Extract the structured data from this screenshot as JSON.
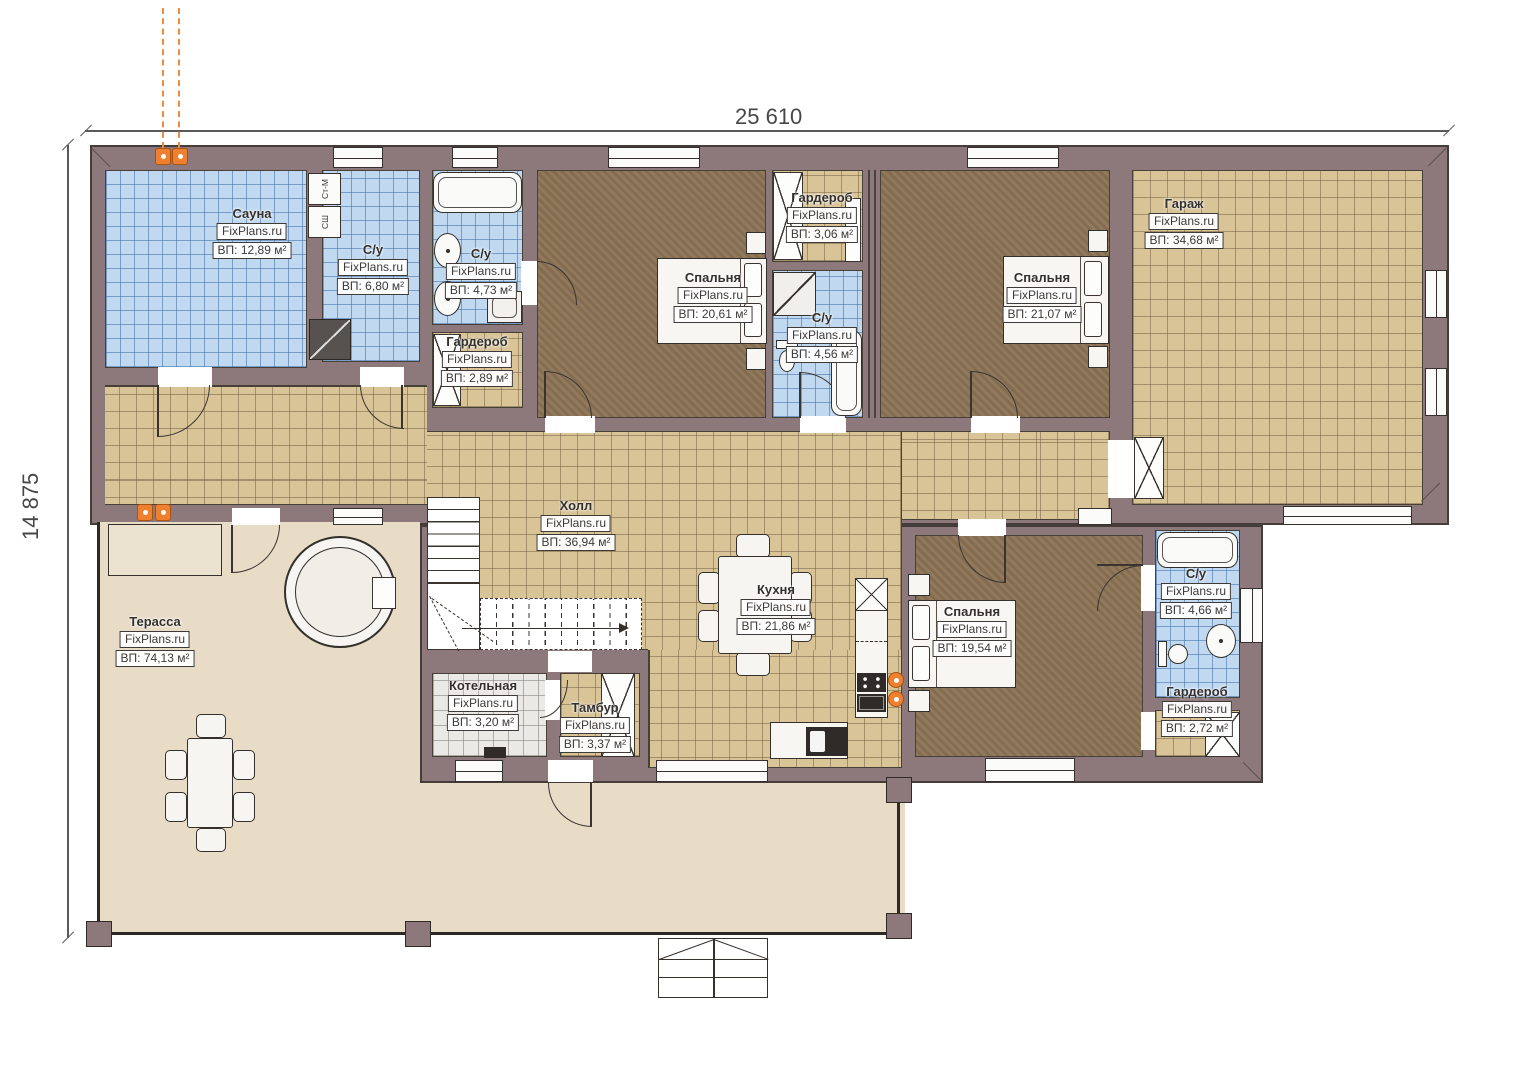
{
  "brand": "FixPlans.ru",
  "dimensions": {
    "top": "25 610",
    "left": "14 875"
  },
  "rooms": [
    {
      "key": "sauna",
      "name": "Сауна",
      "area": "ВП: 12,89 м²"
    },
    {
      "key": "su-1",
      "name": "С/у",
      "area": "ВП: 6,80 м²"
    },
    {
      "key": "su-2",
      "name": "С/у",
      "area": "ВП: 4,73 м²"
    },
    {
      "key": "wardrobe-1",
      "name": "Гардероб",
      "area": "ВП: 2,89 м²"
    },
    {
      "key": "bedroom-1",
      "name": "Спальня",
      "area": "ВП: 20,61 м²"
    },
    {
      "key": "wardrobe-2",
      "name": "Гардероб",
      "area": "ВП: 3,06 м²"
    },
    {
      "key": "su-3",
      "name": "С/у",
      "area": "ВП: 4,56 м²"
    },
    {
      "key": "bedroom-2",
      "name": "Спальня",
      "area": "ВП: 21,07 м²"
    },
    {
      "key": "garage",
      "name": "Гараж",
      "area": "ВП: 34,68 м²"
    },
    {
      "key": "hall",
      "name": "Холл",
      "area": "ВП: 36,94 м²"
    },
    {
      "key": "kitchen",
      "name": "Кухня",
      "area": "ВП: 21,86 м²"
    },
    {
      "key": "bedroom-3",
      "name": "Спальня",
      "area": "ВП: 19,54 м²"
    },
    {
      "key": "su-4",
      "name": "С/у",
      "area": "ВП: 4,66 м²"
    },
    {
      "key": "wardrobe-3",
      "name": "Гардероб",
      "area": "ВП: 2,72 м²"
    },
    {
      "key": "terrace",
      "name": "Терасса",
      "area": "ВП: 74,13 м²"
    },
    {
      "key": "boiler",
      "name": "Котельная",
      "area": "ВП: 3,20 м²"
    },
    {
      "key": "tambour",
      "name": "Тамбур",
      "area": "ВП: 3,37 м²"
    }
  ],
  "appliances": {
    "washer": "Ст-М",
    "dryer": "СШ"
  },
  "colors": {
    "wall": "#8d787b",
    "tile_tan": "#d9c498",
    "tile_blue": "#c0d9f0",
    "floor_dark": "#8b7254",
    "terrace": "#e8dcc7",
    "accent_orange": "#ef8030"
  }
}
